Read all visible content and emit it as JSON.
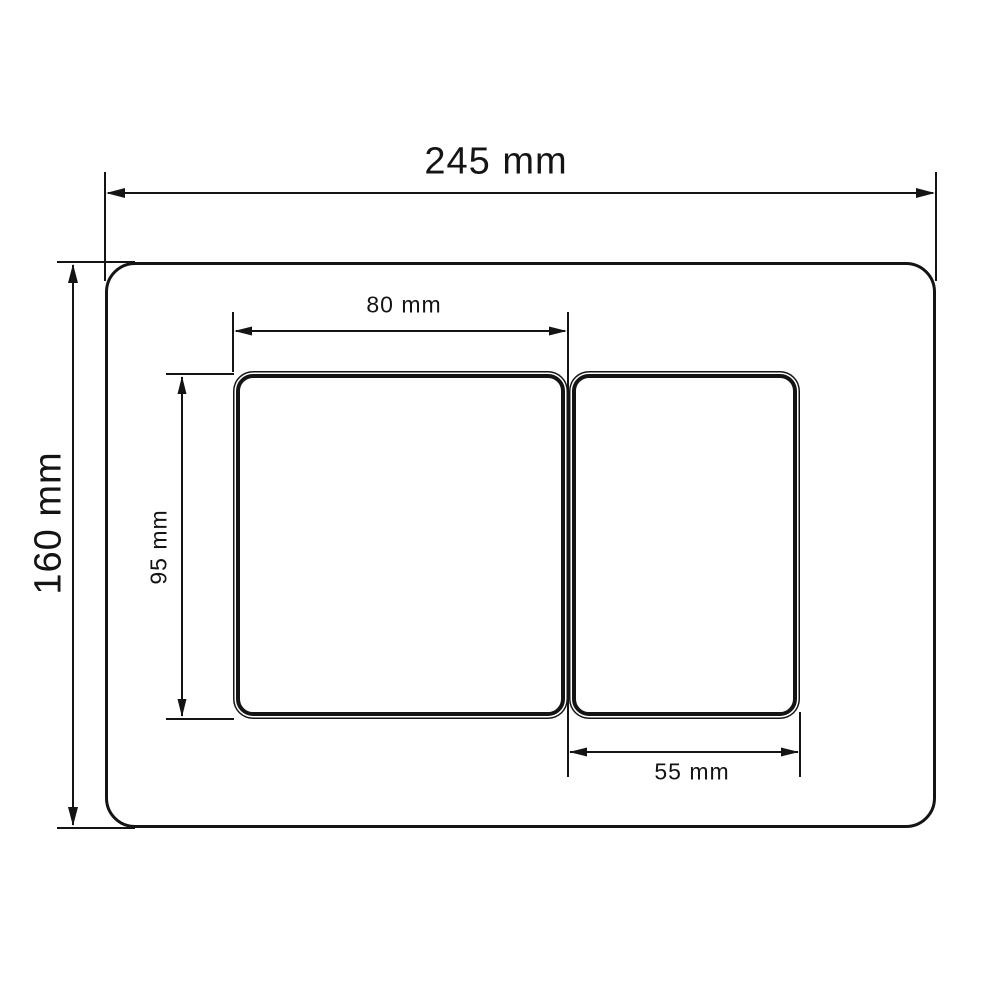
{
  "drawing": {
    "background_color": "#ffffff",
    "line_color": "#141414",
    "shapes": {
      "plate": "rounded-rectangle-outline",
      "large_button": "rounded-rectangle-double-outline",
      "small_button": "rounded-rectangle-double-outline"
    },
    "dimensions": {
      "plate_width": {
        "label": "245 mm",
        "orientation": "horizontal"
      },
      "plate_height": {
        "label": "160 mm",
        "orientation": "vertical"
      },
      "large_button_width": {
        "label": "80 mm",
        "orientation": "horizontal"
      },
      "large_button_height": {
        "label": "95 mm",
        "orientation": "vertical"
      },
      "small_button_width": {
        "label": "55 mm",
        "orientation": "horizontal"
      }
    }
  }
}
